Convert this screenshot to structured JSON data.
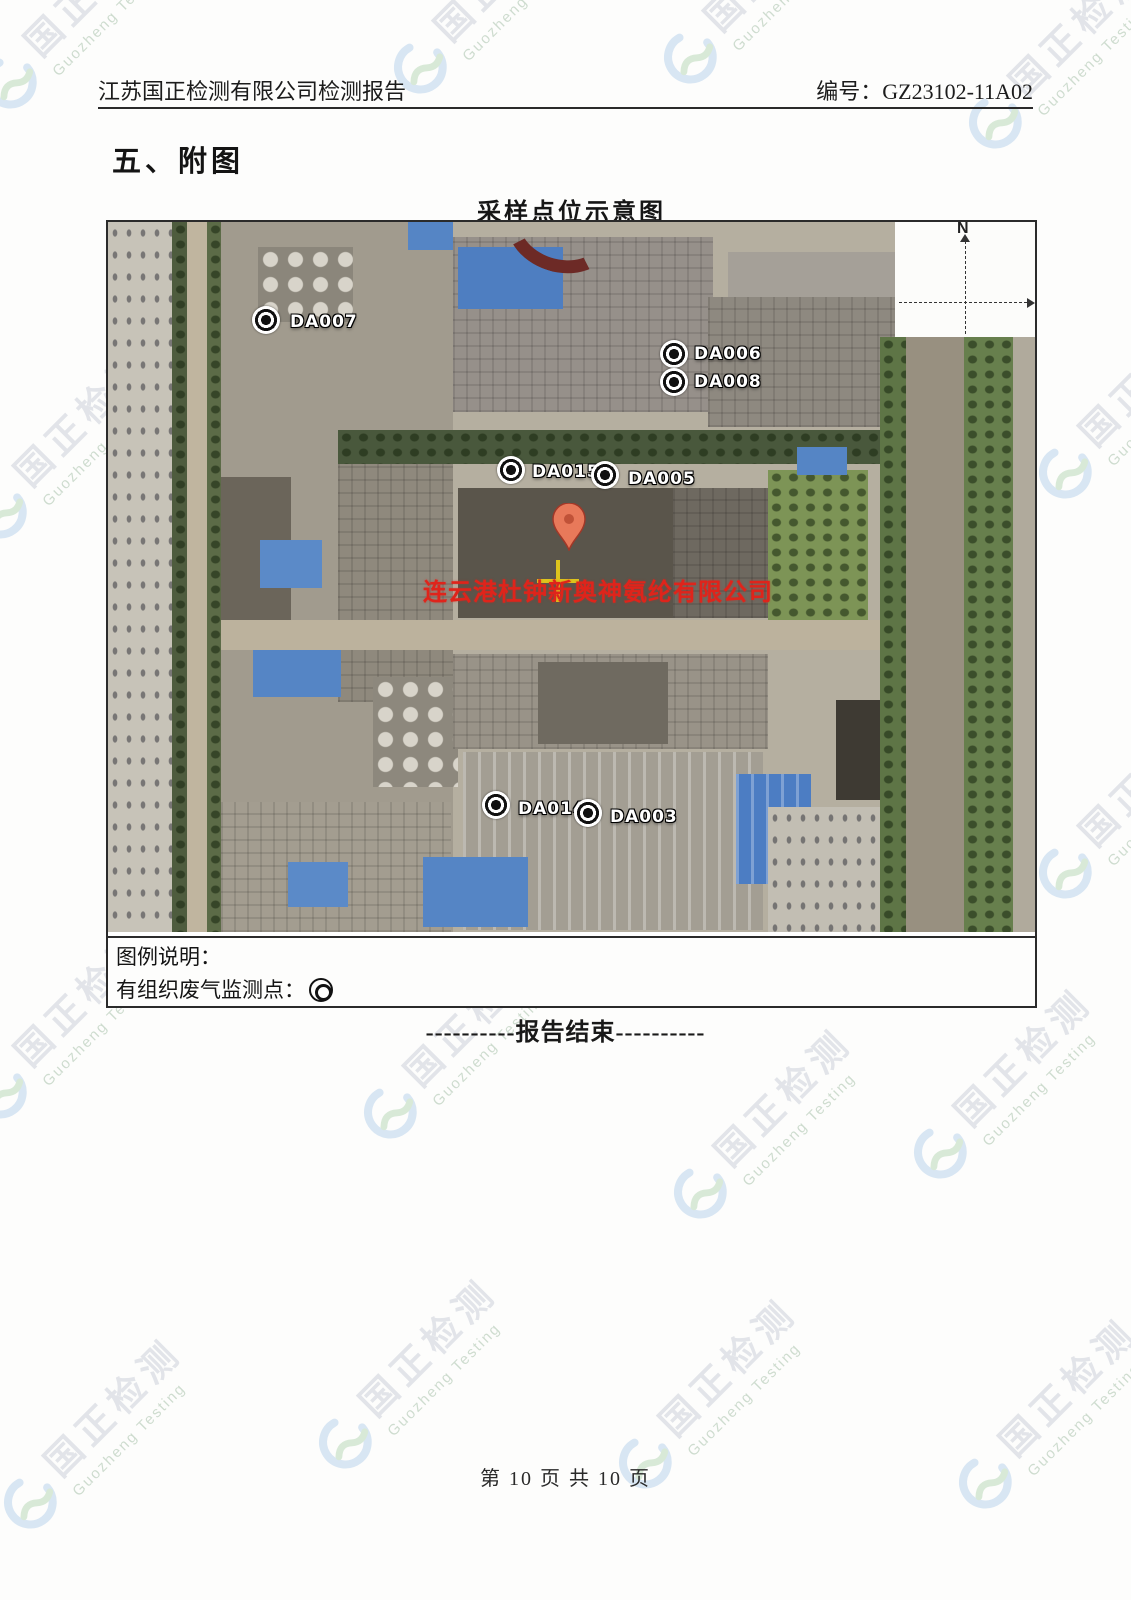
{
  "header": {
    "left": "江苏国正检测有限公司检测报告",
    "right": "编号：GZ23102-11A02"
  },
  "section_title": "五、附图",
  "map_title": "采样点位示意图",
  "map": {
    "company_label": "连云港杜钟新奥神氨纶有限公司",
    "compass_label": "N",
    "markers": [
      {
        "id": "DA007"
      },
      {
        "id": "DA006"
      },
      {
        "id": "DA008"
      },
      {
        "id": "DA015"
      },
      {
        "id": "DA005"
      },
      {
        "id": "DA014"
      },
      {
        "id": "DA003"
      }
    ]
  },
  "legend": {
    "title": "图例说明：",
    "item_label": "有组织废气监测点："
  },
  "report_end": "----------报告结束----------",
  "footer": {
    "page_text": "第 10 页 共 10 页"
  },
  "watermark": {
    "cn": "国正检测",
    "en": "Guozheng Testing"
  },
  "colors": {
    "accent_red": "#df241b",
    "marker_black": "#101010",
    "blue_roof": "#5585c5",
    "watermark_gray": "#ccd1da",
    "watermark_green": "#a9c2ab"
  }
}
